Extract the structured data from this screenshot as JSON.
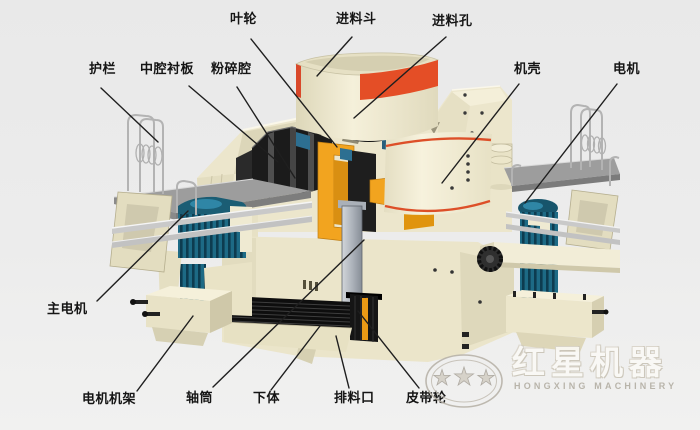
{
  "labels": {
    "yelun": "叶轮",
    "jinliaodou": "进料斗",
    "jinliaokong": "进料孔",
    "hulan": "护栏",
    "zhongqiangchenban": "中腔衬板",
    "fensuiqiang": "粉碎腔",
    "jike": "机壳",
    "dianji": "电机",
    "zhudianji": "主电机",
    "dianjijijia": "电机机架",
    "zhoutong": "轴筒",
    "xiati": "下体",
    "pailiaokou": "排料口",
    "pidailun": "皮带轮"
  },
  "watermark": {
    "brand_cn": "红星机器",
    "brand_en": "HONGXING MACHINERY"
  },
  "colors": {
    "background": "#ebebeb",
    "body_cream": "#ece6cc",
    "body_shade": "#dcd6b9",
    "accent_red": "#e04e27",
    "accent_orange": "#f2a41f",
    "motor_teal": "#1d6a85",
    "motor_dark": "#0d3c50",
    "platform_gray": "#9d9d9d",
    "leader_line": "#1f1f1f"
  }
}
